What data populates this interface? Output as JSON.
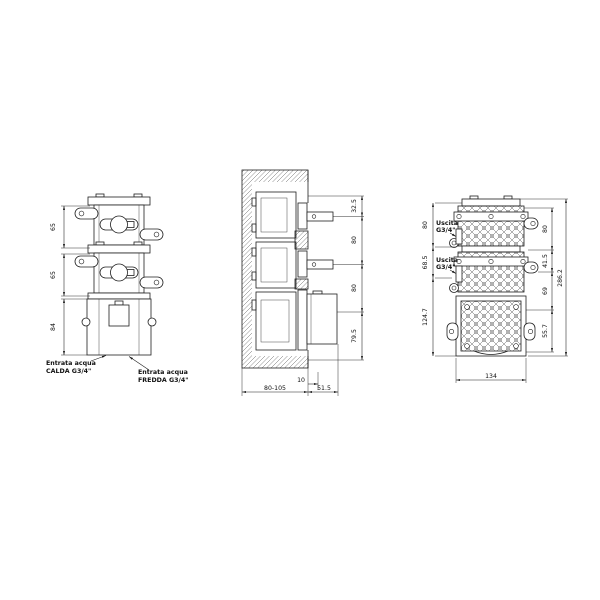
{
  "drawing": {
    "type": "technical-installation-drawing",
    "front_view": {
      "dim_module1": "65",
      "dim_module2": "65",
      "dim_body": "84",
      "label_hot_line1": "Entrata acqua",
      "label_hot_line2": "CALDA G3/4\"",
      "label_cold_line1": "Entrata acqua",
      "label_cold_line2": "FREDDA G3/4\""
    },
    "section_view": {
      "dim_top": "32.5",
      "dim_mid1": "80",
      "dim_mid2": "80",
      "dim_bottom": "79.5",
      "dim_plaster": "10",
      "dim_depth": "80-105",
      "dim_protrusion": "51.5"
    },
    "back_view": {
      "outlet1_line1": "Uscita",
      "outlet1_line2": "G3/4\"",
      "outlet2_line1": "Uscita",
      "outlet2_line2": "G3/4\"",
      "dim_left_top": "80",
      "dim_left_mid": "68.5",
      "dim_left_bottom": "124.7",
      "dim_right_top": "80",
      "dim_right_mid1": "41.5",
      "dim_right_mid2": "69",
      "dim_right_bottom": "55.7",
      "dim_overall": "286.2",
      "dim_width": "134"
    }
  }
}
